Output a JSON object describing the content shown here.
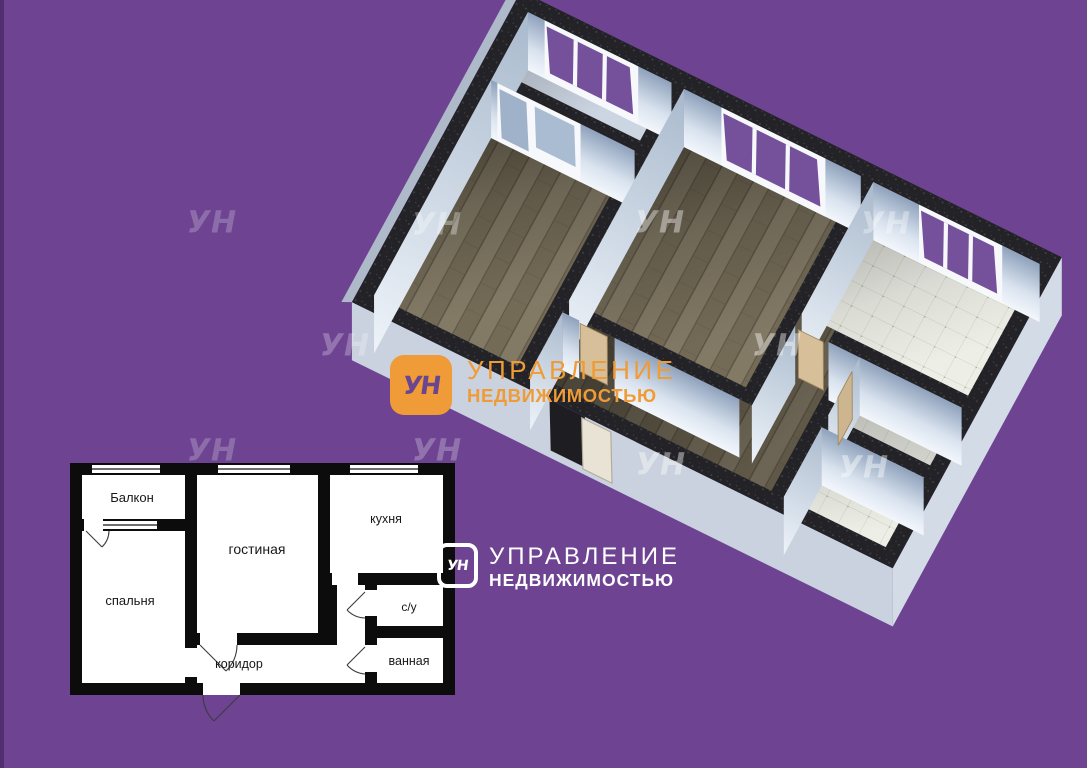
{
  "canvas": {
    "width": 1087,
    "height": 768,
    "background": "#6d4392"
  },
  "palette": {
    "purple_background": "#6d4392",
    "brand_orange": "#ef9b38",
    "wall_dark": "#232327",
    "wood_floor": "#7b7160",
    "tile_floor": "#edeee6",
    "window_glass_purple": "#75519c",
    "exterior_skirt": "#c9d2de",
    "door_tan": "#d7bf9a"
  },
  "watermark": {
    "text": "УН",
    "items": [
      {
        "x": 212,
        "y": 224,
        "o": 0.22
      },
      {
        "x": 345,
        "y": 347,
        "o": 0.26
      },
      {
        "x": 437,
        "y": 226,
        "o": 0.32
      },
      {
        "x": 660,
        "y": 224,
        "o": 0.4
      },
      {
        "x": 886,
        "y": 225,
        "o": 0.34
      },
      {
        "x": 777,
        "y": 347,
        "o": 0.42
      },
      {
        "x": 864,
        "y": 469,
        "o": 0.42
      },
      {
        "x": 661,
        "y": 466,
        "o": 0.42
      },
      {
        "x": 212,
        "y": 452,
        "o": 0.22
      },
      {
        "x": 437,
        "y": 452,
        "o": 0.25
      }
    ]
  },
  "logo_primary": {
    "monogram": "УН",
    "line1": "УПРАВЛЕНИЕ",
    "line2": "НЕДВИЖИМОСТЬЮ",
    "accent": "#ef9b38"
  },
  "logo_secondary": {
    "monogram": "УН",
    "line1": "УПРАВЛЕНИЕ",
    "line2": "НЕДВИЖИМОСТЬЮ",
    "color": "#ffffff"
  },
  "floorplan_2d": {
    "rooms": {
      "balcony": "Балкон",
      "bedroom": "спальня",
      "living": "гостиная",
      "kitchen": "кухня",
      "wc": "с/у",
      "bath": "ванная",
      "corridor": "коридор"
    }
  }
}
